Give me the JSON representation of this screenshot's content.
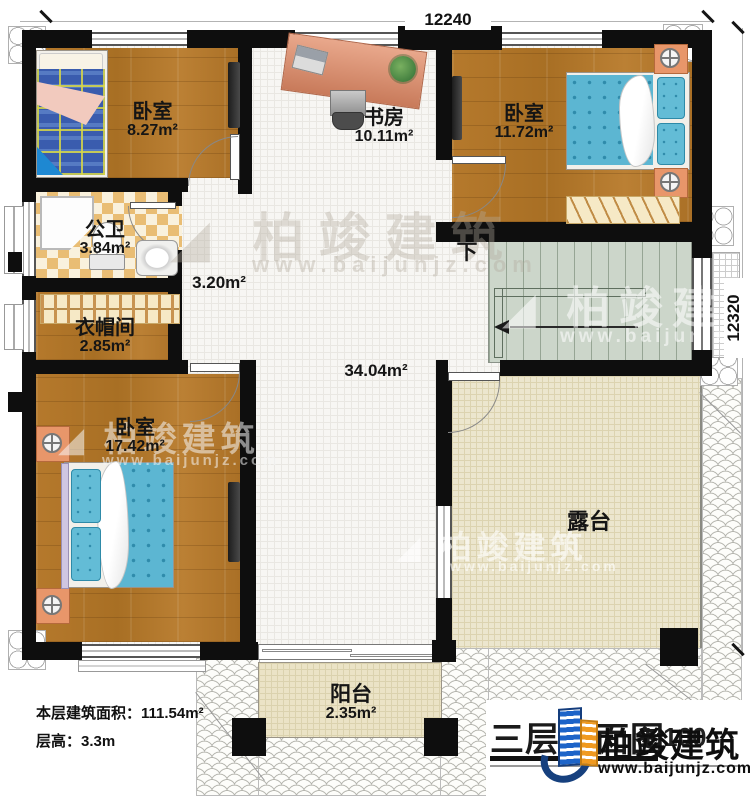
{
  "dimensions": {
    "top": "12240",
    "right": "12320"
  },
  "rooms": {
    "bedroom_top_left": {
      "name": "卧室",
      "area": "8.27m²"
    },
    "study": {
      "name": "书房",
      "area": "10.11m²"
    },
    "bedroom_top_right": {
      "name": "卧室",
      "area": "11.72m²"
    },
    "bathroom": {
      "name": "公卫",
      "area": "3.84m²"
    },
    "cloakroom": {
      "name": "衣帽间",
      "area": "2.85m²"
    },
    "bedroom_main": {
      "name": "卧室",
      "area": "17.42m²"
    },
    "corridor": {
      "area": "3.20m²"
    },
    "hall": {
      "area": "34.04m²"
    },
    "terrace": {
      "name": "露台"
    },
    "balcony": {
      "name": "阳台",
      "area": "2.35m²"
    }
  },
  "stairs": {
    "direction_label": "下"
  },
  "footer": {
    "floor_area_label": "本层建筑面积：",
    "floor_area_value": "111.54m²",
    "floor_height_label": "层高：",
    "floor_height_value": "3.3m"
  },
  "title": {
    "text": "三层平面图",
    "scale": "1:100"
  },
  "brand": {
    "name": "柏竣建筑",
    "website": "www.baijunjz.com",
    "blue": "#1d64c8",
    "orange": "#f09a20"
  },
  "watermark": {
    "name": "柏竣建筑",
    "website": "www.baijunjz.com"
  }
}
